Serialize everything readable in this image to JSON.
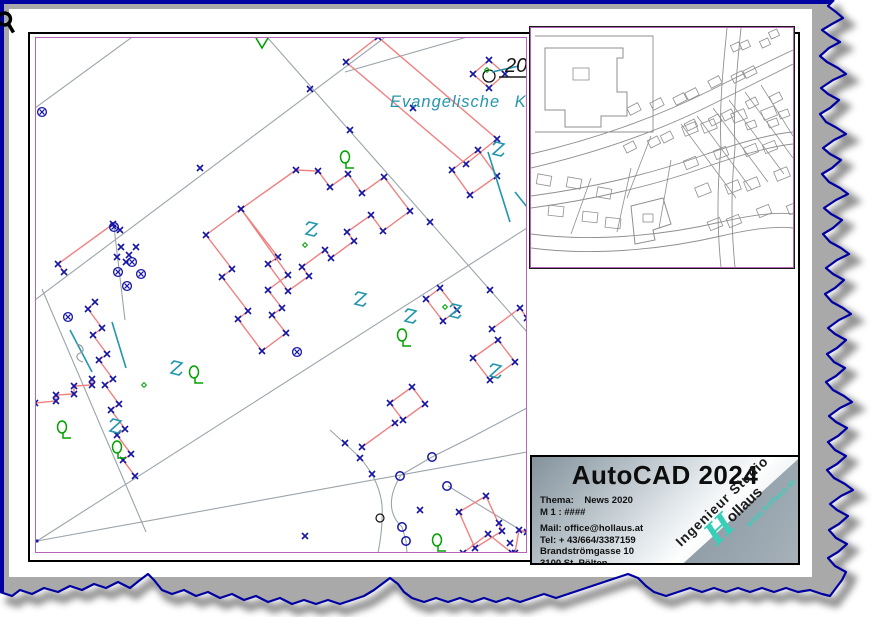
{
  "cursor": {
    "icon": "zoom-magnifier-icon"
  },
  "colors": {
    "background": "#a9a9a9",
    "torn_edge": "#0000a2",
    "paper": "#ffffff",
    "frame": "#000000",
    "viewport_border": "#b565b5",
    "parcel_line": "#9aa4ab",
    "building_line": "#f08080",
    "vertex_marker": "#1515a5",
    "vegetation_green": "#00a300",
    "utility_teal": "#2196ad",
    "overview_line": "#8f8f8f",
    "logo_teal": "#38cfba"
  },
  "main_plan": {
    "church_label": "Evangelische Kirche",
    "house_number": "20"
  },
  "title_block": {
    "product": "AutoCAD 2024",
    "info_lines": [
      "Thema:    News 2020",
      "M 1 : ####",
      "",
      "Mail: office@hollaus.at",
      "Tel: + 43/664/3387159",
      "Brandströmgasse 10",
      "3100 St. Pölten",
      "",
      "Alfred NESWADBA",
      "Tel: +43/664/3387157"
    ],
    "logo": {
      "line1": "Ingenieur Studio",
      "initial": "H",
      "line2": "ollaus",
      "url": "www.hollaus.at"
    }
  }
}
